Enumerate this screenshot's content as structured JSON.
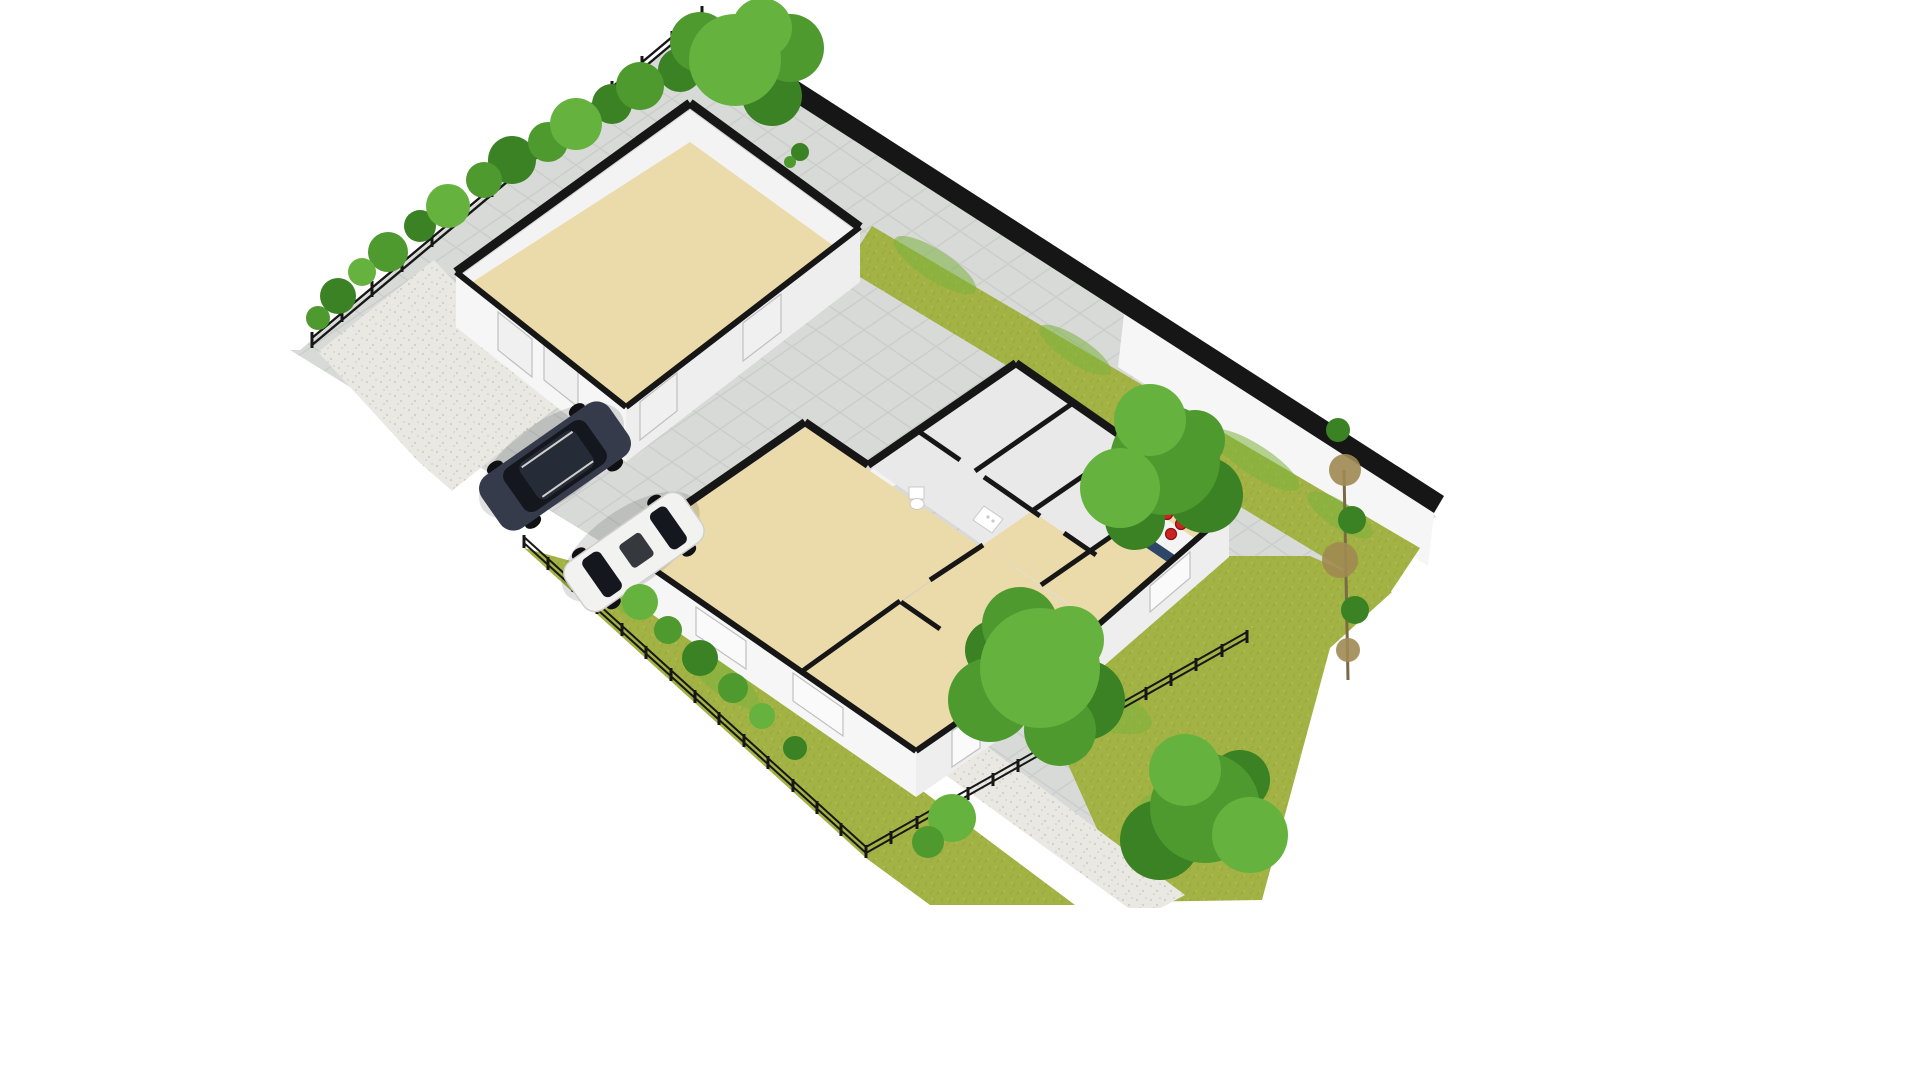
{
  "scene": {
    "type": "3d-floor-plan-render",
    "view": "isometric-birdseye",
    "background": "#ffffff"
  },
  "colors": {
    "paving_base": "#d8dad8",
    "paving_line": "#c6c8c6",
    "gravel": "#eae8e2",
    "gravel_dot": "#d0cdc5",
    "grass_base": "#a3b244",
    "grass_dark": "#8da32f",
    "grass_bright": "#7cb23f",
    "grass_light": "#bac953",
    "tree_g1": "#4e9a2e",
    "tree_g2": "#66b23e",
    "tree_g3": "#3a8223",
    "tree_brown": "#a08a52",
    "trunk_brown": "#7a6a45",
    "wall_black": "#161616",
    "wall_white": "#f6f6f6",
    "wall_face": "#eeeeef",
    "wall_face_light": "#f3f3f3",
    "floor_tan": "#ecdbaa",
    "floor_tile": "#e9e9e9",
    "door_panel": "#f0f0f1",
    "door_frame": "#c0c0c0",
    "window_glass": "#fafafa",
    "counter_navy": "#2e4668",
    "counter_top": "#f4f4f4",
    "burner_red": "#cc2323",
    "burner_ring": "#8b1111",
    "fixture_white": "#ffffff",
    "fixture_edge": "#c9c9c9",
    "suv_body": "#353b4a",
    "suv_roof": "#262b38",
    "glass_dark": "#14171d",
    "car_white": "#f2f2f0",
    "car_trim": "#cfcfcc",
    "wheel_dark": "#101012",
    "fence_black": "#171717",
    "shadow": "#000000"
  },
  "objects": {
    "buildings": {
      "garage": {
        "kind": "outbuilding",
        "floor": "tan",
        "doors": 4
      },
      "house": {
        "kind": "single-story-house",
        "rooms": [
          "living-room",
          "hallway",
          "bedroom",
          "corridor",
          "wc",
          "utility",
          "bathroom",
          "kitchen"
        ],
        "fixtures": [
          "toilet",
          "utility-appliance",
          "washbasin",
          "kitchen-counter-cooktop",
          "kitchen-sink-unit"
        ],
        "cooktop_burners": 4
      }
    },
    "vehicles": [
      {
        "name": "dark-suv"
      },
      {
        "name": "white-car"
      }
    ],
    "landscape": {
      "boundary": [
        "boundary-wall-northeast",
        "rail-fence-northwest",
        "picket-fence-southwest",
        "picket-fence-southeast"
      ],
      "planting": [
        "hedge-row-northwest",
        "large-tree-top",
        "right-garden-trees",
        "bottom-garden-trees",
        "garden-bushes",
        "garage-sapling"
      ],
      "ground": [
        "paved-courtyard",
        "gravel-area-west",
        "gravel-walkway",
        "garden-path",
        "lawn-northeast-strip",
        "lawn-southwest",
        "lawn-southeast"
      ]
    }
  }
}
